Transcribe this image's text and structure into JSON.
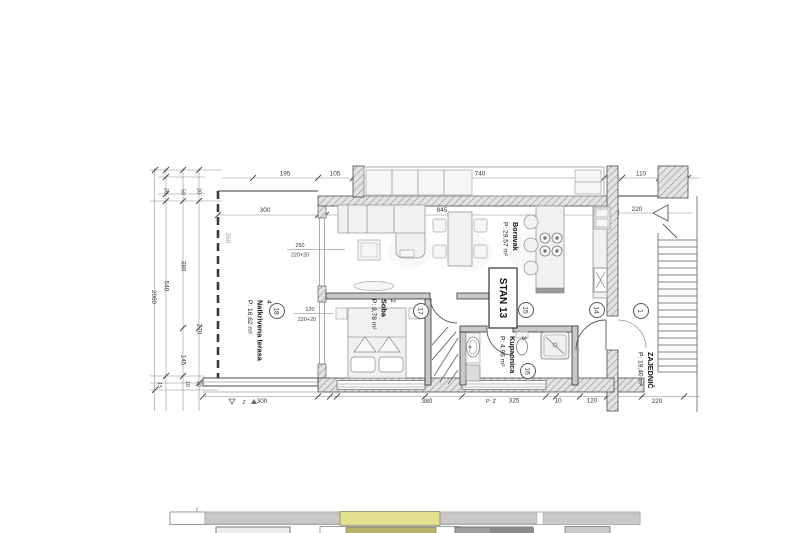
{
  "plan": {
    "unit_label": "STAN 13",
    "rooms": {
      "boravak": {
        "name": "Boravak",
        "area": "P: 29,57 m²"
      },
      "soba": {
        "number": "2",
        "name": "Soba",
        "area": "P: 9,78 m²"
      },
      "kupaonica": {
        "number": "3",
        "name": "Kupaonica",
        "area": "P: 4,96 m²"
      },
      "terasa": {
        "number": "4",
        "name": "Natkrivena terasa",
        "area": "P: 16,62 m²"
      },
      "zajednicki": {
        "name": "ZAJEDNIČ",
        "area": "P: 19,40 m²"
      }
    },
    "markers": {
      "m1": "1",
      "m14": "14",
      "m15": "15",
      "m16": "16",
      "m17": "17",
      "m18": "18"
    },
    "dims": {
      "top_195": "195",
      "top_105": "105",
      "top_740": "740",
      "top_110": "110",
      "top_30": "30",
      "in_300": "300",
      "in_845": "845",
      "right_220": "220",
      "right_20": "20",
      "left_2060": "2060",
      "left_540": "540",
      "left_380": "380",
      "left_260": "260",
      "left_270": "270",
      "left_145": "145",
      "left_20a": "20",
      "left_50": "50",
      "left_20b": "20",
      "left_15": "15",
      "left_10": "10",
      "left_20c": "20",
      "bot_300": "300",
      "bot_30": "30",
      "bot_380": "380",
      "bot_325": "325",
      "bot_10": "10",
      "bot_120": "120",
      "bot_220": "220"
    },
    "window_annotations": {
      "a1_w": "250",
      "a1_h": "220+20",
      "a2_w": "120",
      "a2_h": "220+20"
    },
    "fragments": {
      "z": "Z",
      "pz": "P: Ž"
    }
  },
  "colors": {
    "highlight": "#e2df8f",
    "key_olive": "#b5b26a",
    "key_gray": "#c8c8c8",
    "key_dark": "#9e9e9e"
  }
}
